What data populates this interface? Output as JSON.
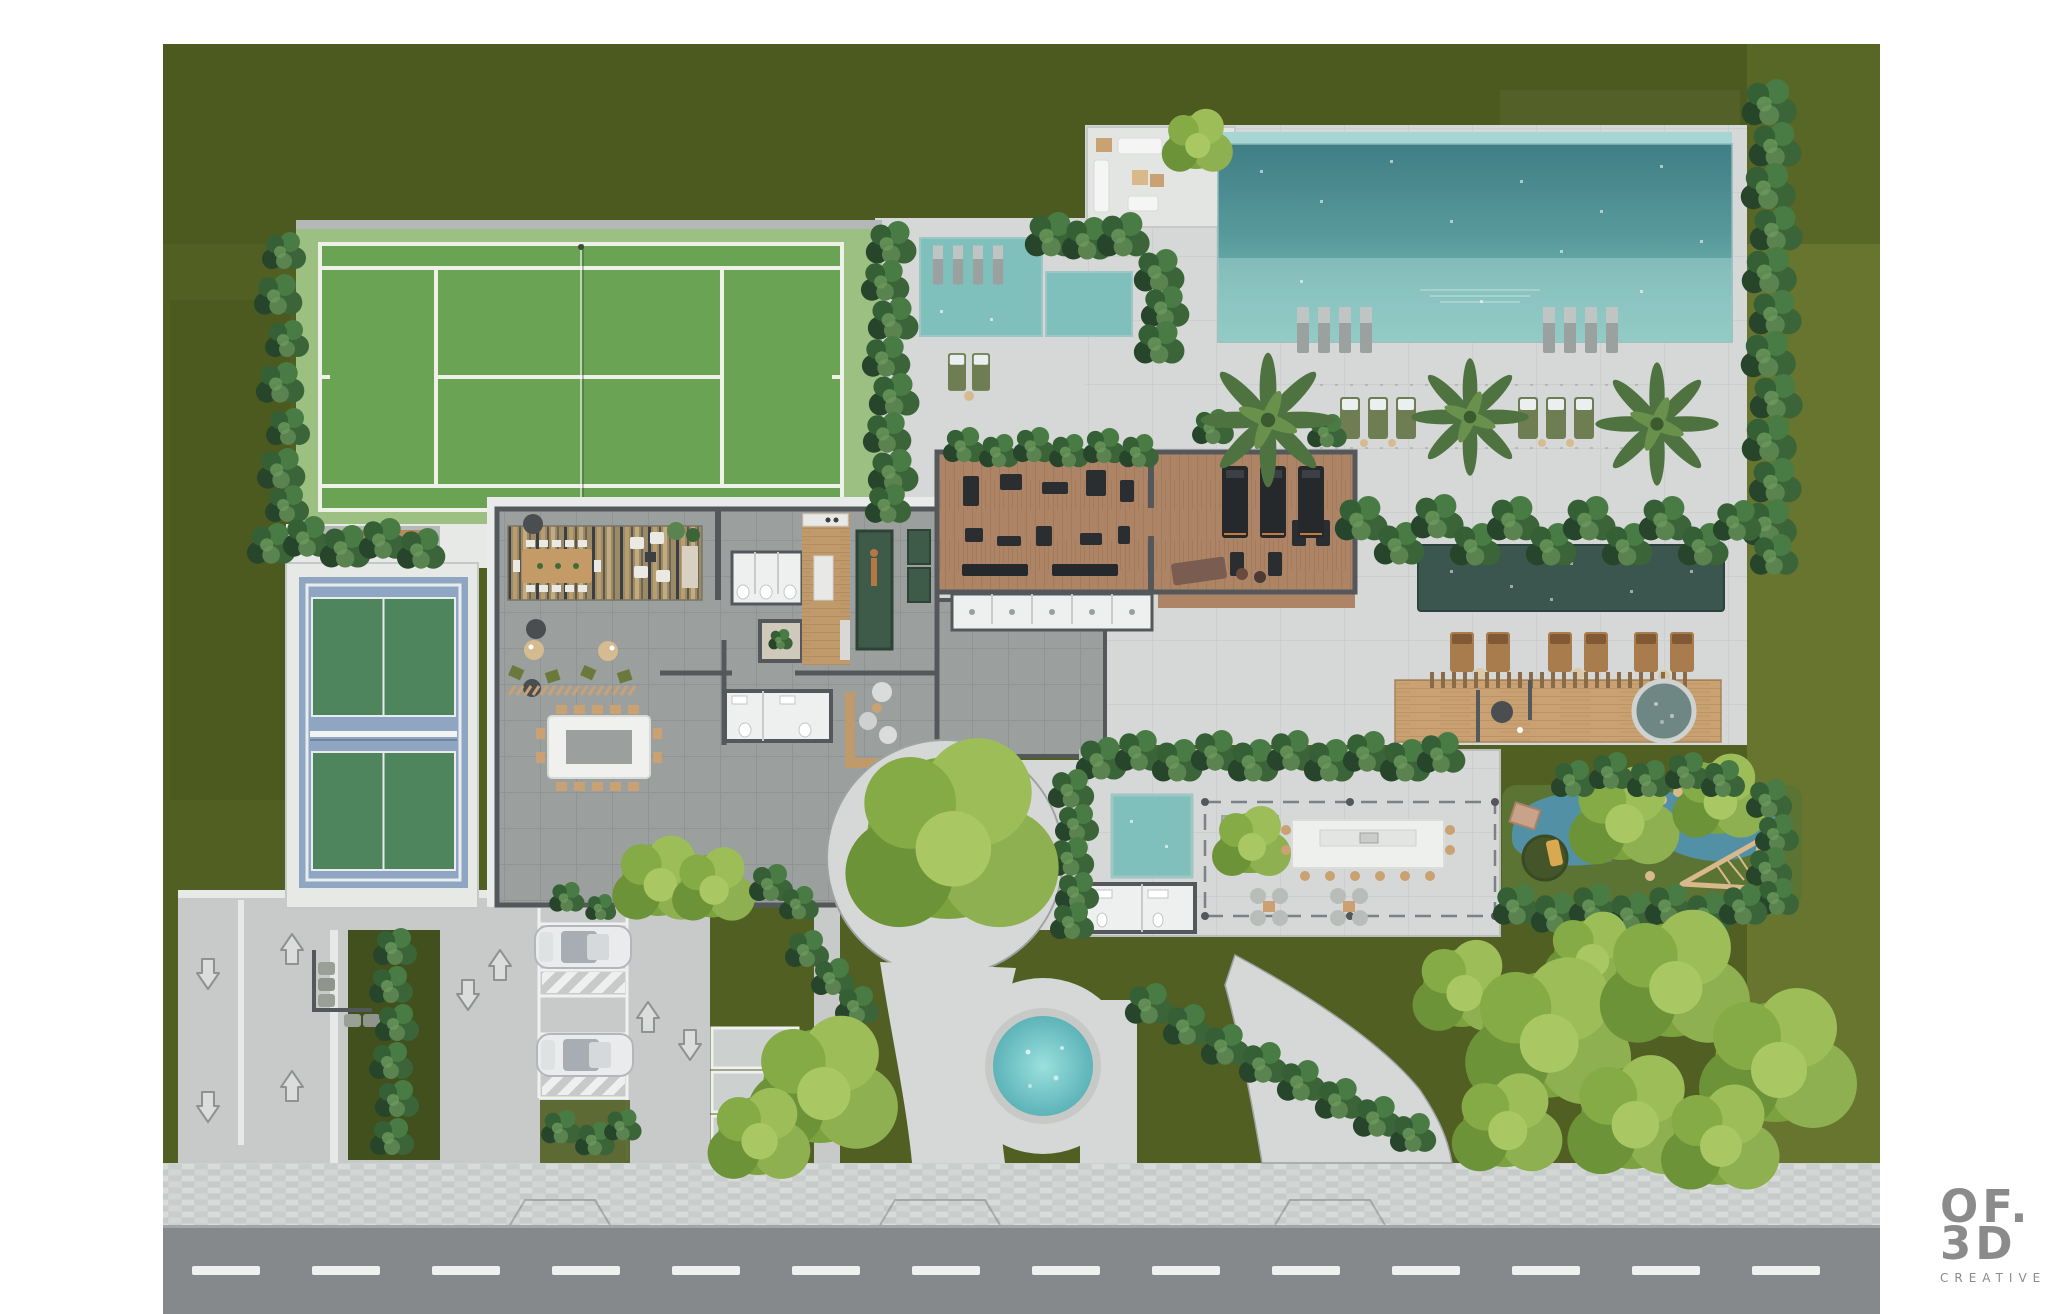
{
  "logo": {
    "line1": "OF.",
    "line2": "3D",
    "line3": "CREATIVE"
  },
  "palette": {
    "lawn": "#515f22",
    "lawnLight": "#6b7931",
    "deck": "#d5d8d6",
    "deckBright": "#e7e9e7",
    "road": "#85898c",
    "roadLine": "#eff1f0",
    "paver": "#cdd1d0",
    "wall": "#54585b",
    "waterDeep": "#44838a",
    "waterLight": "#7fc0bd",
    "waterDark": "#3a564e",
    "plunge": "#6fc4c5",
    "tennisApron": "#9cc081",
    "tennisCourt": "#6ba355",
    "courtLine": "#edf1e8",
    "pickleBlue": "#8fa6c2",
    "pickleGreen": "#4f855c",
    "hedge": "#2f5232",
    "tree": "#7ba23f",
    "treeLight": "#9cbd58",
    "palm": "#5a7d41",
    "wood": "#c19a6b",
    "woodDeck": "#c9a172",
    "gymFloor": "#ad8465",
    "equip": "#2b2e30",
    "rubber": "#5c7433",
    "rubberBlue": "#5290a5",
    "whiteRoom": "#eef0ef",
    "interior": "#9b9f9d",
    "tan": "#d6bb90",
    "logoGrey": "#8b8b8b"
  }
}
